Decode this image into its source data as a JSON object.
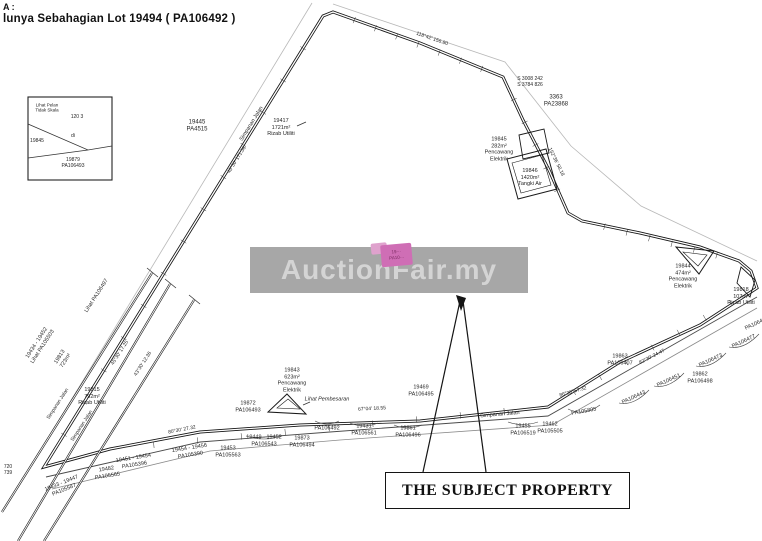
{
  "header": {
    "line1": "A :",
    "line2": "lunya Sebahagian Lot 19494 ( PA106492 )"
  },
  "watermark": {
    "text": "AuctionFair.my",
    "band_color": "#a7a7a7",
    "text_color": "#d4d4d4"
  },
  "subject_property": {
    "box_label": "THE SUBJECT PROPERTY",
    "highlight_color": "#cf6eb5",
    "highlight_lines": [
      "19···",
      "PA10···"
    ]
  },
  "labels": [
    {
      "name": "label-lot-19445",
      "lines": [
        "19445",
        "PA4515"
      ],
      "x": 197,
      "y": 127,
      "size": 6
    },
    {
      "name": "label-rizab-19417",
      "lines": [
        "19417",
        "1721m²",
        "Rizab Utiliti"
      ],
      "x": 281,
      "y": 128,
      "size": 5.5
    },
    {
      "name": "label-simpanan-jalan-top",
      "lines": [
        "Simpanan Jalan"
      ],
      "x": 252,
      "y": 124,
      "rot": -58,
      "size": 5.5
    },
    {
      "name": "label-bearing-top-left",
      "lines": [
        "43°30' 171.36"
      ],
      "x": 237,
      "y": 160,
      "rot": -58,
      "size": 5
    },
    {
      "name": "label-bearing-top-edge",
      "lines": [
        "118°42' 156.80"
      ],
      "x": 432,
      "y": 39,
      "rot": 19,
      "size": 5
    },
    {
      "name": "label-marker-s3008",
      "lines": [
        "S 3008 242",
        "S 3784 826"
      ],
      "x": 530,
      "y": 82,
      "size": 5
    },
    {
      "name": "label-lot-3363",
      "lines": [
        "3363",
        "PA23868"
      ],
      "x": 556,
      "y": 102,
      "size": 6
    },
    {
      "name": "label-bearing-right-upper",
      "lines": [
        "152°36' 58.18"
      ],
      "x": 556,
      "y": 162,
      "rot": 64,
      "size": 5
    },
    {
      "name": "label-lot-19845",
      "lines": [
        "19845",
        "282m²",
        "Pencawang",
        "Elektrik"
      ],
      "x": 499,
      "y": 150,
      "size": 5.5
    },
    {
      "name": "label-lot-19846",
      "lines": [
        "19846",
        "1420m²",
        "Tangki Air"
      ],
      "x": 530,
      "y": 178,
      "size": 5.5
    },
    {
      "name": "label-lot-19844",
      "lines": [
        "19844",
        "474m²",
        "Pencawang",
        "Elektrik"
      ],
      "x": 683,
      "y": 277,
      "size": 5.5
    },
    {
      "name": "label-lot-19818",
      "lines": [
        "19818",
        "107m²",
        "Rizab Utiliti"
      ],
      "x": 741,
      "y": 297,
      "size": 5.5
    },
    {
      "name": "label-lot-19863",
      "lines": [
        "19863",
        "PA106407"
      ],
      "x": 620,
      "y": 360,
      "size": 5.5
    },
    {
      "name": "label-lot-19862",
      "lines": [
        "19862",
        "PA106498"
      ],
      "x": 700,
      "y": 378,
      "size": 5.5
    },
    {
      "name": "label-plan-pa106443",
      "lines": [
        "PA106443"
      ],
      "x": 634,
      "y": 398,
      "rot": -25,
      "size": 5.5
    },
    {
      "name": "label-plan-pa106451",
      "lines": [
        "PA106451"
      ],
      "x": 669,
      "y": 381,
      "rot": -25,
      "size": 5.5
    },
    {
      "name": "label-plan-pa106473",
      "lines": [
        "PA106473"
      ],
      "x": 711,
      "y": 361,
      "rot": -25,
      "size": 5.5
    },
    {
      "name": "label-plan-pa106477",
      "lines": [
        "PA106477"
      ],
      "x": 744,
      "y": 342,
      "rot": -25,
      "size": 5.5
    },
    {
      "name": "label-plan-pa106478",
      "lines": [
        "PA106478"
      ],
      "x": 757,
      "y": 324,
      "rot": -25,
      "size": 5.5
    },
    {
      "name": "label-bearing-right-road",
      "lines": [
        "82°30' 24.47"
      ],
      "x": 652,
      "y": 357,
      "rot": -27,
      "size": 5
    },
    {
      "name": "label-lot-19469",
      "lines": [
        "19469",
        "PA106495"
      ],
      "x": 421,
      "y": 391,
      "size": 5.5
    },
    {
      "name": "label-bearing-bottom-1",
      "lines": [
        "67°04' 18.55"
      ],
      "x": 372,
      "y": 409,
      "rot": -3,
      "size": 5
    },
    {
      "name": "label-simpanan-jalan-bottom",
      "lines": [
        "Simpanan Jalan"
      ],
      "x": 500,
      "y": 415,
      "rot": -5,
      "size": 5.5
    },
    {
      "name": "label-bearing-bottom-2",
      "lines": [
        "86°30' 57.32"
      ],
      "x": 573,
      "y": 392,
      "rot": -16,
      "size": 5
    },
    {
      "name": "label-bearing-bottom-3",
      "lines": [
        "80°30' 27.32"
      ],
      "x": 182,
      "y": 430,
      "rot": -11,
      "size": 5
    },
    {
      "name": "label-lot-19872",
      "lines": [
        "19872",
        "PA106493"
      ],
      "x": 248,
      "y": 407,
      "size": 5.5
    },
    {
      "name": "label-lot-19843",
      "lines": [
        "19843",
        "623m²",
        "Pencawang",
        "Elektrik"
      ],
      "x": 292,
      "y": 381,
      "size": 5.5
    },
    {
      "name": "label-lihat-pembesaran",
      "lines": [
        "Lihat Pembesaran"
      ],
      "x": 327,
      "y": 400,
      "size": 5.5,
      "italic": true
    },
    {
      "name": "label-plan-pa106492",
      "lines": [
        "PA106492"
      ],
      "x": 327,
      "y": 429,
      "size": 5.5
    },
    {
      "name": "label-lot-19431",
      "lines": [
        "19431",
        "PA106561"
      ],
      "x": 364,
      "y": 430,
      "size": 5.5
    },
    {
      "name": "label-lot-19861",
      "lines": [
        "19861",
        "PA106496"
      ],
      "x": 408,
      "y": 432,
      "size": 5.5
    },
    {
      "name": "label-lot-19873",
      "lines": [
        "19873",
        "PA106494"
      ],
      "x": 302,
      "y": 442,
      "size": 5.5
    },
    {
      "name": "label-range-19449",
      "lines": [
        "19449 - 19452",
        "PA106543"
      ],
      "x": 264,
      "y": 441,
      "size": 5.5
    },
    {
      "name": "label-lot-19453",
      "lines": [
        "19453",
        "PA105563"
      ],
      "x": 228,
      "y": 452,
      "size": 5.5
    },
    {
      "name": "label-range-19451",
      "lines": [
        "19451 - 19454",
        "PA105396"
      ],
      "x": 134,
      "y": 462,
      "rot": -9,
      "size": 5.5
    },
    {
      "name": "label-range-19454",
      "lines": [
        "19454 - 19456",
        "PA105390"
      ],
      "x": 190,
      "y": 452,
      "rot": -9,
      "size": 5.5
    },
    {
      "name": "label-lot-19482",
      "lines": [
        "19482",
        "PA105565"
      ],
      "x": 107,
      "y": 473,
      "rot": -9,
      "size": 5.5
    },
    {
      "name": "label-range-19433",
      "lines": [
        "19433 - 19447",
        "PA105587"
      ],
      "x": 63,
      "y": 487,
      "rot": -22,
      "size": 5.5
    },
    {
      "name": "label-lot-19455",
      "lines": [
        "19455",
        "PA106519"
      ],
      "x": 523,
      "y": 430,
      "size": 5.5
    },
    {
      "name": "label-lot-19462",
      "lines": [
        "19462",
        "PA105505"
      ],
      "x": 550,
      "y": 428,
      "size": 5.5
    },
    {
      "name": "label-plan-pa105805",
      "lines": [
        "PA105805"
      ],
      "x": 584,
      "y": 412,
      "rot": -10,
      "size": 5.5
    },
    {
      "name": "label-lihat-pa106497",
      "lines": [
        "Lihat PA106497"
      ],
      "x": 97,
      "y": 296,
      "rot": -57,
      "size": 5.5
    },
    {
      "name": "label-range-19434-lihat",
      "lines": [
        "19434 - 19452",
        "Lihat PA105503"
      ],
      "x": 40,
      "y": 345,
      "rot": -57,
      "size": 5.5
    },
    {
      "name": "label-simpanan-jalan-left1",
      "lines": [
        "Simpanan Jalan"
      ],
      "x": 58,
      "y": 404,
      "rot": -57,
      "size": 5
    },
    {
      "name": "label-simpanan-jalan-left2",
      "lines": [
        "Simpanan Jalan"
      ],
      "x": 82,
      "y": 426,
      "rot": -57,
      "size": 5
    },
    {
      "name": "label-bearing-left1",
      "lines": [
        "45°30' 17.25"
      ],
      "x": 120,
      "y": 353,
      "rot": -57,
      "size": 5
    },
    {
      "name": "label-bearing-left2",
      "lines": [
        "43°30' 12.36"
      ],
      "x": 143,
      "y": 364,
      "rot": -57,
      "size": 5
    },
    {
      "name": "label-lot-19813",
      "lines": [
        "19813",
        "723m²"
      ],
      "x": 63,
      "y": 359,
      "rot": -57,
      "size": 5.5
    },
    {
      "name": "label-lot-19815",
      "lines": [
        "19815",
        "792m²",
        "Rizab Utiliti"
      ],
      "x": 92,
      "y": 397,
      "size": 5.5
    },
    {
      "name": "label-edge-numbers",
      "lines": [
        "720",
        "739"
      ],
      "x": 8,
      "y": 470,
      "size": 5
    },
    {
      "name": "label-inset-note",
      "lines": [
        "Lihat Pelan",
        "Tidak Skala"
      ],
      "x": 47,
      "y": 108,
      "size": 4.5
    },
    {
      "name": "label-inset-top",
      "lines": [
        "120 3"
      ],
      "x": 77,
      "y": 117,
      "size": 5
    },
    {
      "name": "label-inset-left",
      "lines": [
        "19845"
      ],
      "x": 37,
      "y": 141,
      "size": 5
    },
    {
      "name": "label-inset-mid",
      "lines": [
        "di"
      ],
      "x": 73,
      "y": 136,
      "size": 5
    },
    {
      "name": "label-inset-bottom",
      "lines": [
        "19879",
        "PA106493"
      ],
      "x": 73,
      "y": 163,
      "size": 5
    }
  ]
}
